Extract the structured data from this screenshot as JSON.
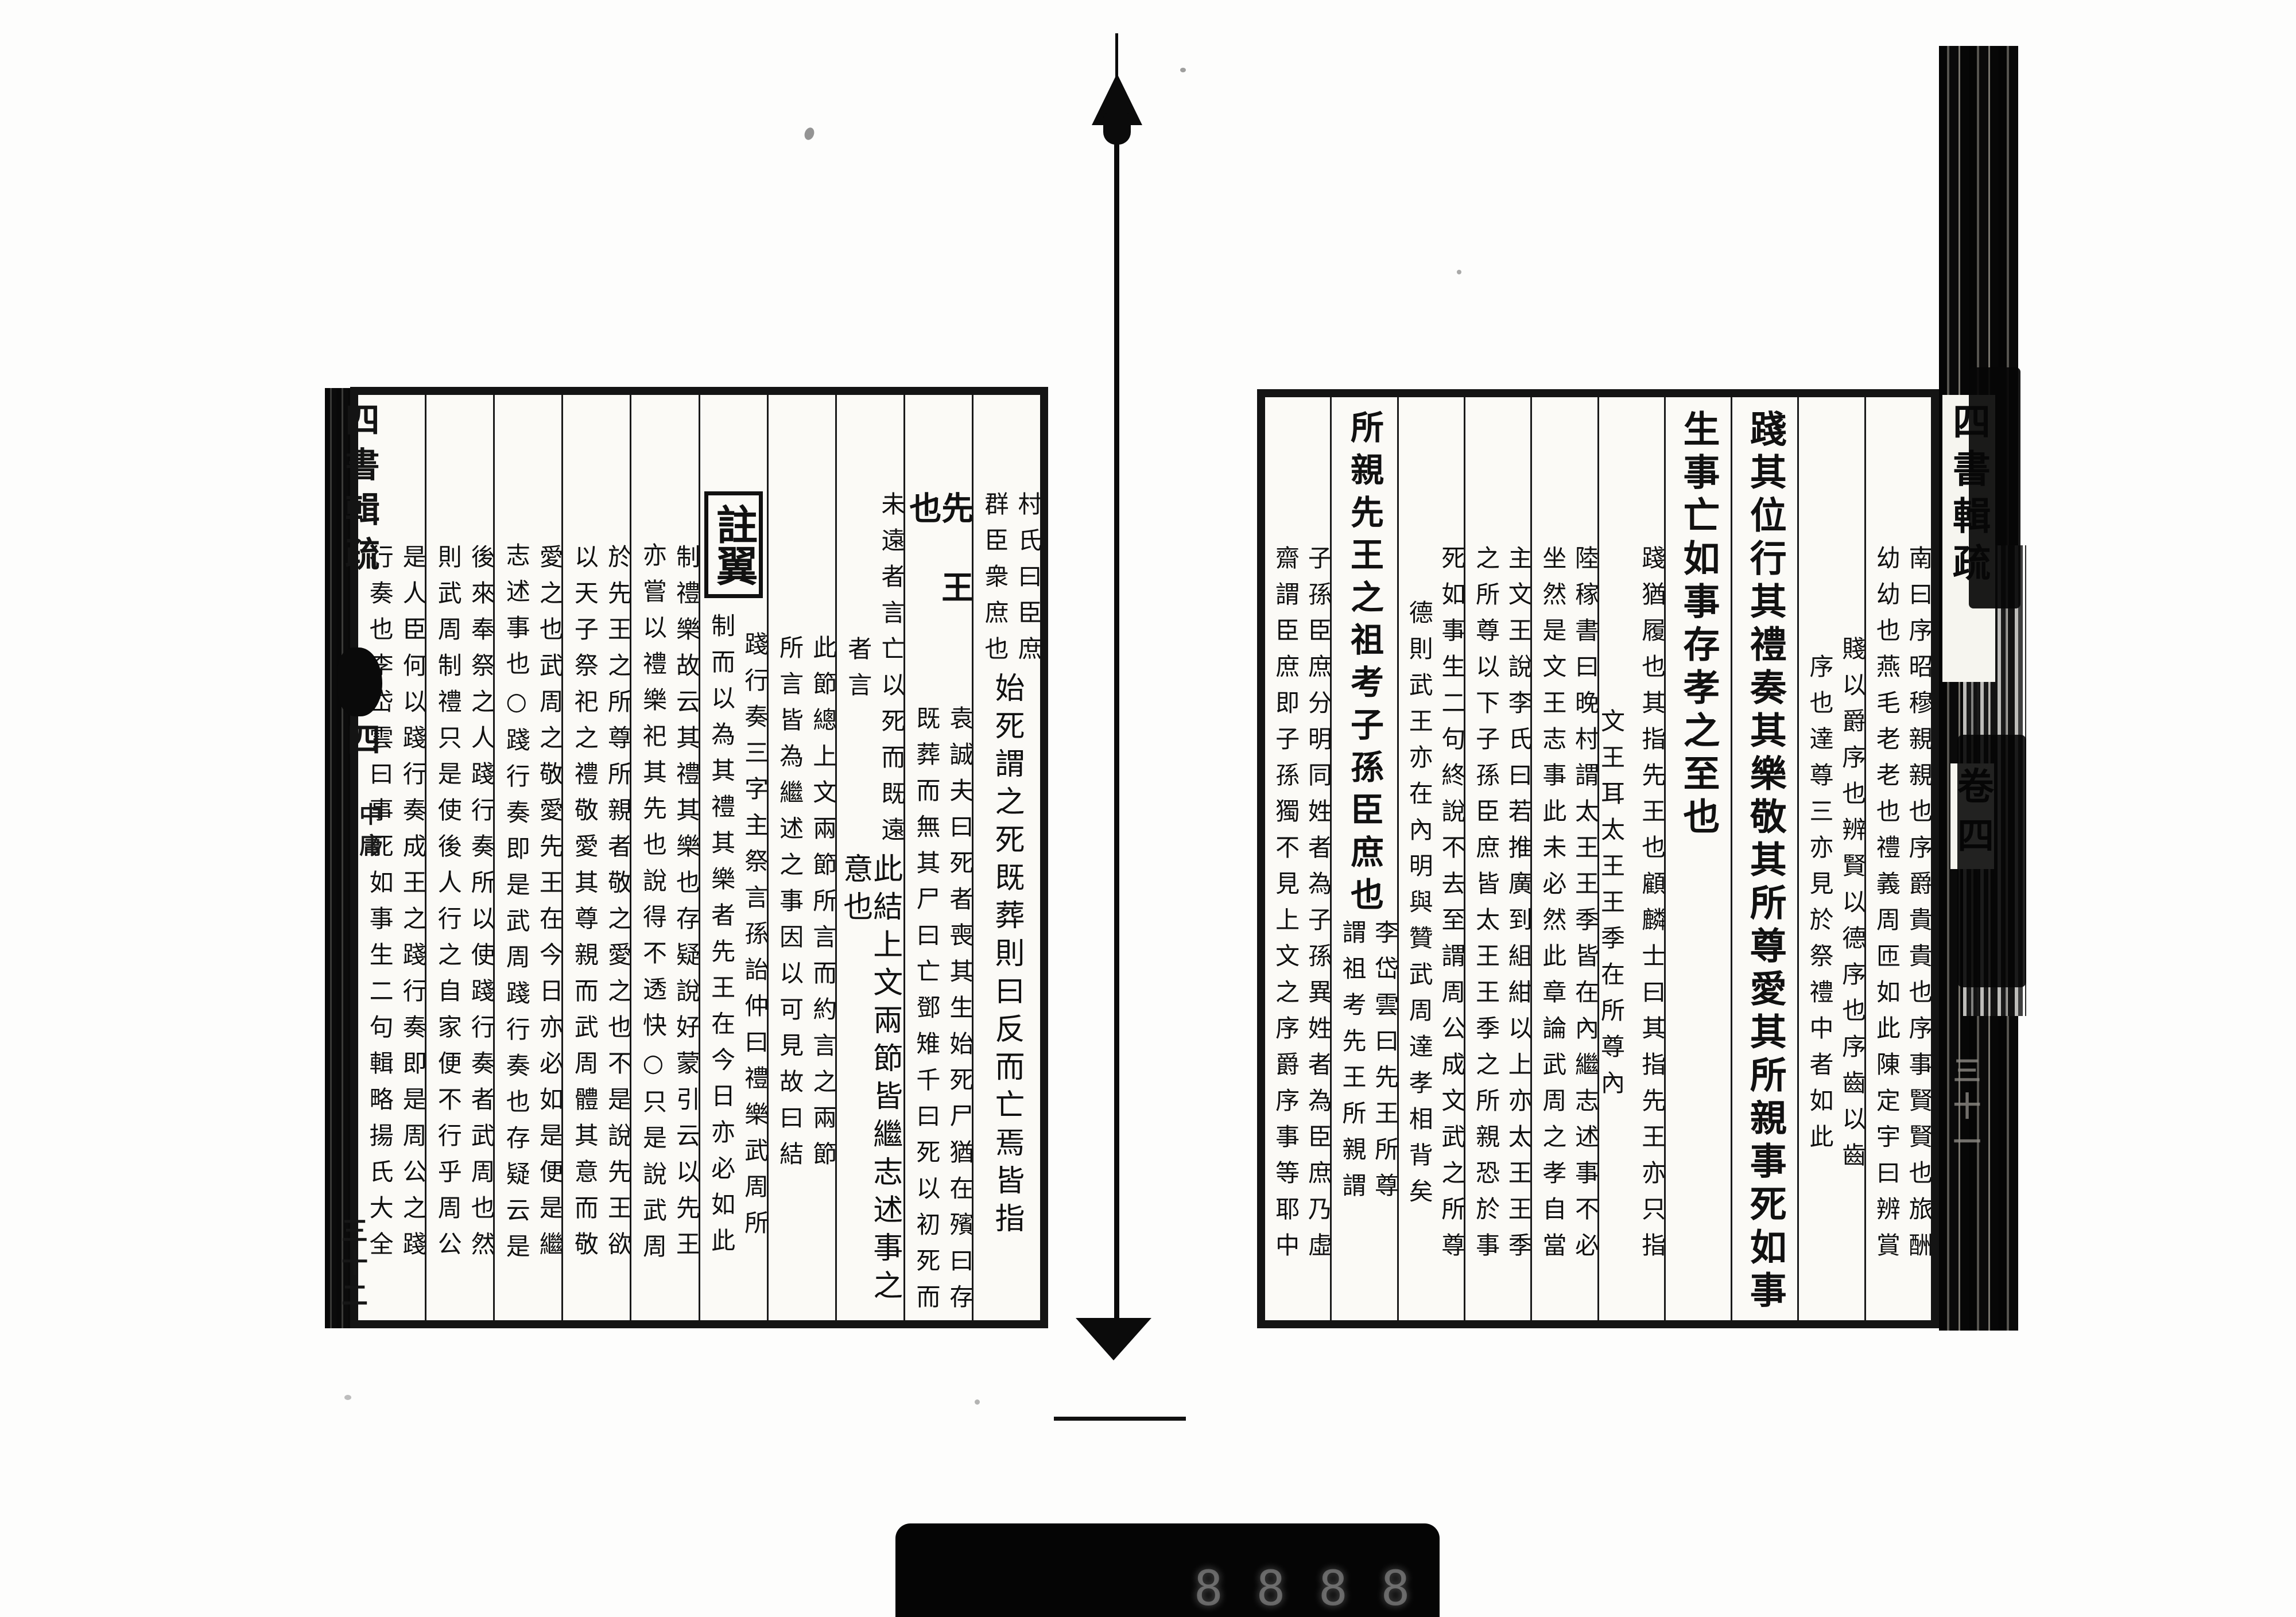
{
  "work": {
    "spine_title": "四書輯疏",
    "spine_volume": "卷四",
    "book_label": "中庸",
    "right_folio": "三十一",
    "left_folio": "三十二",
    "note_box_label": "註翼",
    "ink_color": "#111111",
    "paper_color": "#fbfaf6"
  },
  "right_page": {
    "columns": [
      {
        "inset": true,
        "segments": [
          {
            "type": "pair",
            "r": "南曰序昭穆親親也序爵貴貴也序事賢賢也旅酬",
            "l": "幼幼也燕毛老老也禮義周匝如此陳定宇曰辨賞"
          }
        ]
      },
      {
        "inset": true,
        "segments": [
          {
            "type": "pair",
            "r": "賤以爵序也辨賢以德序也序齒以齒",
            "l": "序也達尊三亦見於祭禮中者如此"
          }
        ]
      },
      {
        "inset": false,
        "segments": [
          {
            "type": "large",
            "text": "踐其位行其禮奏其樂敬其所尊愛其所親事死如事"
          }
        ]
      },
      {
        "inset": false,
        "segments": [
          {
            "type": "large",
            "text": "生事亡如事存孝之至也"
          }
        ]
      },
      {
        "inset": true,
        "segments": [
          {
            "type": "pair",
            "r": "踐猶履也其指先王也顧麟士曰其指先王亦只指",
            "l": "文王耳太王王季在所尊內",
            "l_align": "end"
          }
        ]
      },
      {
        "inset": true,
        "segments": [
          {
            "type": "pair",
            "r": "陸稼書曰晚村謂太王王季皆在內繼志述事不必",
            "l": "坐然是文王志事此未必然此章論武周之孝自當"
          }
        ]
      },
      {
        "inset": true,
        "segments": [
          {
            "type": "pair",
            "r": "主文王說李氏曰若推廣到組紺以上亦太王王季",
            "l": "之所尊以下子孫臣庶皆太王王季之所親恐於事"
          }
        ]
      },
      {
        "inset": true,
        "segments": [
          {
            "type": "pair",
            "r": "死如事生二句終說不去至謂周公成文武之所尊",
            "l": "德則武王亦在內明與贊武周達孝相背矣"
          }
        ]
      },
      {
        "inset": false,
        "segments": [
          {
            "type": "medium",
            "text": "所親先王之祖考子孫臣庶也"
          },
          {
            "type": "pair",
            "r": "李岱雲曰先王所尊",
            "l": "謂祖考先王所親謂"
          }
        ]
      },
      {
        "inset": true,
        "segments": [
          {
            "type": "pair",
            "r": "子孫臣庶分明同姓者為子孫異姓者為臣庶乃虛",
            "l": "齋謂臣庶即子孫獨不見上文之序爵序事等耶中"
          }
        ]
      }
    ]
  },
  "left_page": {
    "columns": [
      {
        "inset": true,
        "segments": [
          {
            "type": "pair",
            "r": "村氏曰臣庶",
            "l": "群臣衆庶也"
          },
          {
            "type": "single",
            "text": "始死謂之死既葬則曰反而亡焉皆指"
          }
        ]
      },
      {
        "inset": true,
        "segments": [
          {
            "type": "spread",
            "text": "先王也"
          },
          {
            "type": "pair",
            "r": "袁誠夫曰死者喪其生始死尸猶在殯曰存",
            "l": "既葬而無其尸曰亡鄧雉千曰死以初死而"
          }
        ]
      },
      {
        "inset": true,
        "segments": [
          {
            "type": "pair",
            "r": "未遠者言亡以死而既遠",
            "l": "者言"
          },
          {
            "type": "single",
            "text": "此結上文兩節皆繼志述事之意也"
          }
        ]
      },
      {
        "inset": true,
        "segments": [
          {
            "type": "pair",
            "r": "此節總上文兩節所言而約言之兩節",
            "l": "所言皆為繼述之事因以可見故曰結"
          }
        ]
      },
      {
        "inset": true,
        "segments": [
          {
            "type": "box",
            "text": "註翼"
          },
          {
            "type": "pair",
            "r": "踐行奏三字主祭言孫詒仲曰禮樂武周所",
            "l": "制而以為其禮其樂者先王在今日亦必如此"
          }
        ]
      },
      {
        "inset": true,
        "segments": [
          {
            "type": "pair",
            "r": "制禮樂故云其禮其樂也存疑說好蒙引云以先王",
            "l": "亦嘗以禮樂祀其先也說得不透快○只是說武周"
          }
        ]
      },
      {
        "inset": true,
        "segments": [
          {
            "type": "pair",
            "r": "於先王之所尊所親者敬之愛之也不是說先王欲",
            "l": "以天子祭祀之禮敬愛其尊親而武周體其意而敬"
          }
        ]
      },
      {
        "inset": true,
        "segments": [
          {
            "type": "pair",
            "r": "愛之也武周之敬愛先王在今日亦必如是便是繼",
            "l": "志述事也○踐行奏即是武周踐行奏也存疑云是"
          }
        ]
      },
      {
        "inset": true,
        "segments": [
          {
            "type": "pair",
            "r": "後來奉祭之人踐行奏所以使踐行奏者武周也然",
            "l": "則武周制禮只是使後人行之自家便不行乎周公"
          }
        ]
      },
      {
        "inset": true,
        "segments": [
          {
            "type": "pair",
            "r": "是人臣何以踐行奏成王之踐行奏即是周公之踐",
            "l": "行奏也李岱雲曰事死如事生二句輯略揚氏大全"
          }
        ]
      }
    ]
  },
  "counter": {
    "digits": "8888"
  }
}
